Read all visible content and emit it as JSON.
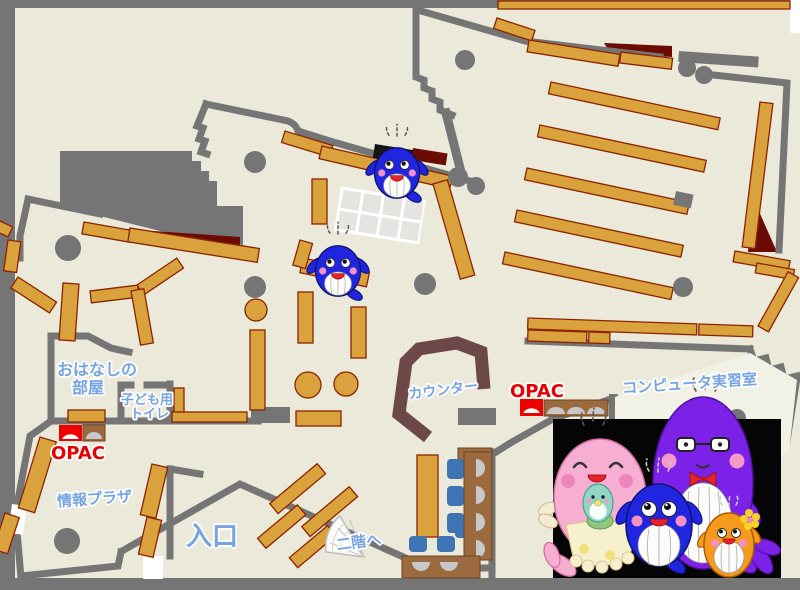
{
  "map": {
    "type": "library-floor-map",
    "labels": {
      "storytelling": {
        "line1": "おはなしの",
        "line2": "部屋"
      },
      "kids_toilet": {
        "line1": "子ども用",
        "line2": "トイレ"
      },
      "opac_left": "OPAC",
      "opac_right": "OPAC",
      "info_plaza": "情報プラザ",
      "entrance": "入口",
      "to_second_floor": "二階へ",
      "counter": "カウンター",
      "computer_room": "コンピュータ実習室"
    },
    "rooms": [
      {
        "id": "storytelling-room",
        "label": "おはなしの部屋"
      },
      {
        "id": "kids-toilet",
        "label": "子ども用トイレ"
      },
      {
        "id": "info-plaza",
        "label": "情報プラザ"
      },
      {
        "id": "computer-room",
        "label": "コンピュータ実習室"
      }
    ],
    "stations": [
      {
        "id": "opac-terminal-left",
        "label": "OPAC",
        "color": "red"
      },
      {
        "id": "opac-terminal-right",
        "label": "OPAC",
        "color": "red"
      }
    ],
    "colors": {
      "floor": "#EBE9DA",
      "computer_room_floor": "#F2F1E6",
      "wall_gray": "#757575",
      "shelf_orange": "#D9A23C",
      "shelf_border": "#8B2300",
      "accent_dark_red": "#6B0B04",
      "counter_brown": "#6D4848",
      "desk_brown": "#9B6B3F",
      "chair_blue": "#3E74B4",
      "label_blue": "#76A3E2",
      "label_red": "#E60000",
      "photo_background": "#050505",
      "mascot_blue": "#2026E0",
      "mascot_pink": "#F6AED2",
      "mascot_purple": "#7C22E8",
      "mascot_orange": "#F59A1C"
    },
    "mascots": {
      "on_map": [
        {
          "type": "whale",
          "color": "blue",
          "location": "upper-center shelf"
        },
        {
          "type": "whale",
          "color": "blue",
          "location": "center shelf"
        }
      ],
      "family_photo": {
        "background": "black",
        "members": [
          {
            "color": "pink",
            "detail": "mother whale with closed happy eyes holding teal baby, frilled apron"
          },
          {
            "color": "purple",
            "detail": "father whale with glasses and red bow tie"
          },
          {
            "color": "blue",
            "detail": "child whale with big eyes, arms up"
          },
          {
            "color": "orange",
            "detail": "small whale with yellow flower and purple tail"
          }
        ]
      }
    }
  }
}
